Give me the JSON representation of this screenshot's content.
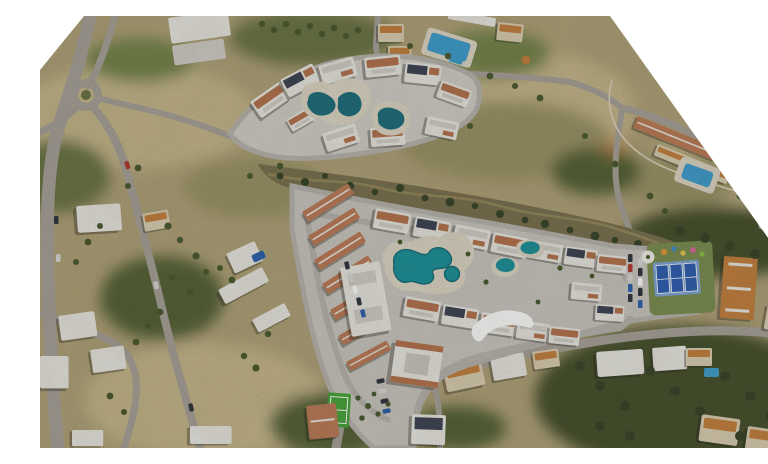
{
  "scene": {
    "kind": "aerial-satellite-composite",
    "subject": "resort-masterplan-overlay",
    "crop_corners": [
      "top-left",
      "top-right"
    ]
  },
  "palette": {
    "terrain_base": "#b1a37a",
    "terrain_pale": "#c6b78c",
    "terrain_scrub": "#9c9468",
    "green_mid": "#6c7446",
    "green_grove": "#566339",
    "green_dark": "#46512e",
    "green_lawn": "#76854c",
    "olive_band": "#7b7250",
    "band_path": "#97895e",
    "road_photo": "#a8a29a",
    "road_render": "#b9b5b0",
    "footpath": "#ded5bd",
    "paving_north": "#d3d0ca",
    "paving_main": "#cbc8c2",
    "deck": "#ded7c6",
    "pool_dark": "#1f6f7d",
    "pool_teal": "#1d929c",
    "pool_blue": "#3f9fd0",
    "tennis_blue": "#2f5fb4",
    "tennis_apron": "#7ea6d8",
    "court_green": "#49a53c",
    "play_base": "#7c8f52",
    "roof_white": "#eae8e2",
    "roof_gray": "#d2cfc8",
    "roof_terracotta": "#b5744f",
    "roof_red": "#bd7c58",
    "roof_dark": "#3d4454",
    "roof_orange": "#c4813f",
    "wall_cream": "#dccfb4",
    "shadow": "rgba(35,35,25,0.35)",
    "white": "#ffffff",
    "dome": "#f1eee7",
    "tree": "#4a5a30",
    "tree_dark": "#39452a",
    "play_orange": "#e09a3a",
    "play_blue": "#3f8fd0",
    "play_lime": "#8cc044",
    "play_pink": "#d86a9c",
    "play_yellow": "#e6c84a",
    "car_dark": "#30353f",
    "car_red": "#b23a30",
    "car_blue": "#2e62b0",
    "car_silver": "#d9d9d9"
  },
  "features": {
    "north_development": {
      "apartment_blocks": 10,
      "pools": 3
    },
    "main_development": {
      "row_houses": 7,
      "apartment_blocks": 16,
      "pools": 4,
      "tennis_courts": 3,
      "sports_courts": 1,
      "playgrounds": 1,
      "parking_areas": 3
    },
    "existing_area": {
      "roundabouts": 1,
      "hotel_pools": 2,
      "terrace_pool": 1,
      "villa_pools": 2
    }
  }
}
